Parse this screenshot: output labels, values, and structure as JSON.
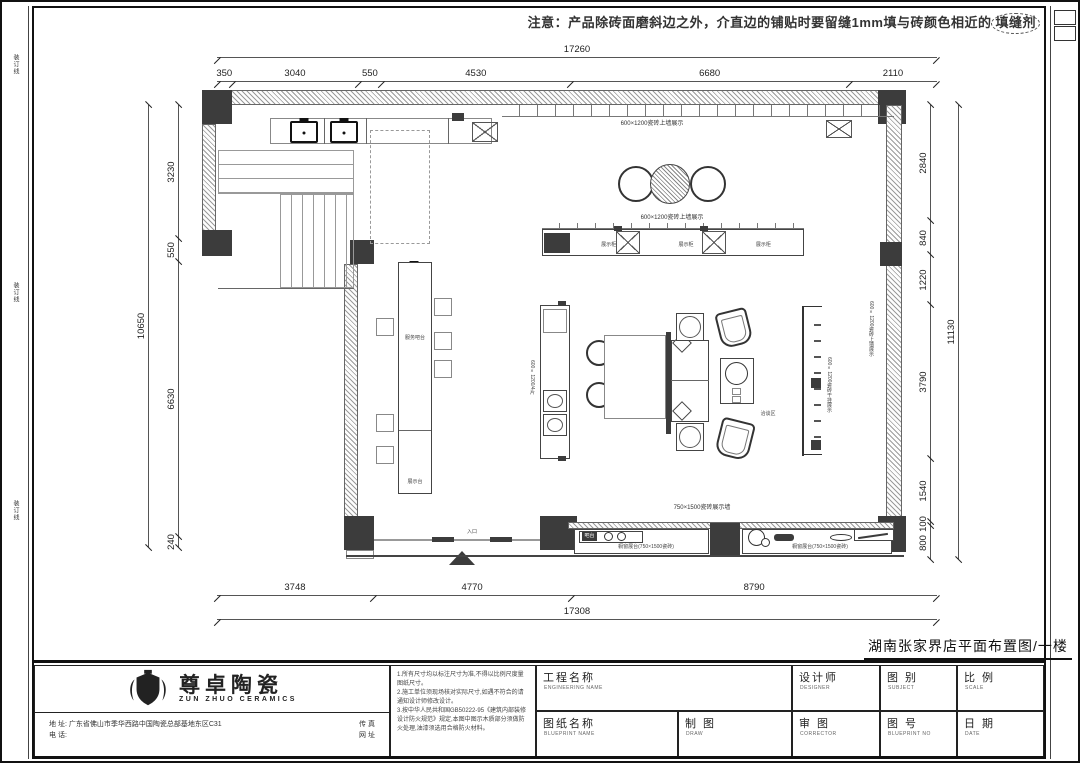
{
  "note": {
    "prefix": "注意：产品除砖面磨斜边之外，介直边的铺贴时要留缝1mm填与砖颜色相近的",
    "circled": "填缝剂"
  },
  "margin_marks": [
    "装订线",
    "装订线",
    "装订线"
  ],
  "dimensions": {
    "top_total": "17260",
    "top_segments": [
      "350",
      "3040",
      "550",
      "4530",
      "6680",
      "2110"
    ],
    "left_total": "10650",
    "left_segments": [
      "3230",
      "550",
      "6630",
      "240"
    ],
    "right_total": "11130",
    "right_segments": [
      "2840",
      "840",
      "1220",
      "3790",
      "1540",
      "100",
      "800"
    ],
    "bottom_segments": [
      "3748",
      "4770",
      "8790"
    ],
    "bottom_total": "17308"
  },
  "plan": {
    "top_wall_label": "600×1200瓷砖上墙展示",
    "island_label": "600×1200瓷砖上墙展示",
    "island_cells": [
      "展示柜",
      "展示柜",
      "展示柜"
    ],
    "left_counter_label": "服务吧台",
    "left_counter_sub_label": "展示台",
    "cabinet_label": "600×1200/4片",
    "sofa_area_label": "洽谈区",
    "right_panel_label": "600×1200瓷砖干挂展示",
    "right_wall_label": "600×1200瓷砖上墙展示",
    "bottom_wall_label": "750×1500瓷砖展示墙",
    "platform_left_label": "橱窗展台(750×1500瓷砖)",
    "platform_right_label": "橱窗展台(750×1500瓷砖)",
    "reception_label": "吧台",
    "entrance_label": "入口"
  },
  "drawing_title": "湖南张家界店平面布置图/一楼",
  "title_block": {
    "logo_cn": "尊卓陶瓷",
    "logo_en": "ZUN ZHUO CERAMICS",
    "notes": [
      "1.所有尺寸均以标注尺寸为准,不得以比例尺度量图纸尺寸。",
      "2.施工单位须现场核对实际尺寸,如遇不符合的请通知设计师修改设计。",
      "3.按中华人民共和国GB50222-95《建筑内部装修设计防火规范》规定,本图中图示木质部分须做防火处理,油漆须选用合格防火材料。"
    ],
    "address_label": "地 址:",
    "address_value": "广东省佛山市季华西路中国陶瓷总部基地东区C31",
    "phone_label": "电 话:",
    "fax_label": "传 真",
    "web_label": "网 址",
    "fields": {
      "project": {
        "cn": "工程名称",
        "en": "ENGINEERING NAME"
      },
      "drawing": {
        "cn": "图纸名称",
        "en": "BLUEPRINT NAME"
      },
      "designer": {
        "cn": "设计师",
        "en": "DESIGNER"
      },
      "category": {
        "cn": "图 别",
        "en": "SUBJECT"
      },
      "scale": {
        "cn": "比 例",
        "en": "SCALE"
      },
      "draftsman": {
        "cn": "制 图",
        "en": "DRAW"
      },
      "checker": {
        "cn": "审 图",
        "en": "CORRECTOR"
      },
      "number": {
        "cn": "图 号",
        "en": "BLUEPRINT NO"
      },
      "date": {
        "cn": "日 期",
        "en": "DATE"
      }
    }
  }
}
